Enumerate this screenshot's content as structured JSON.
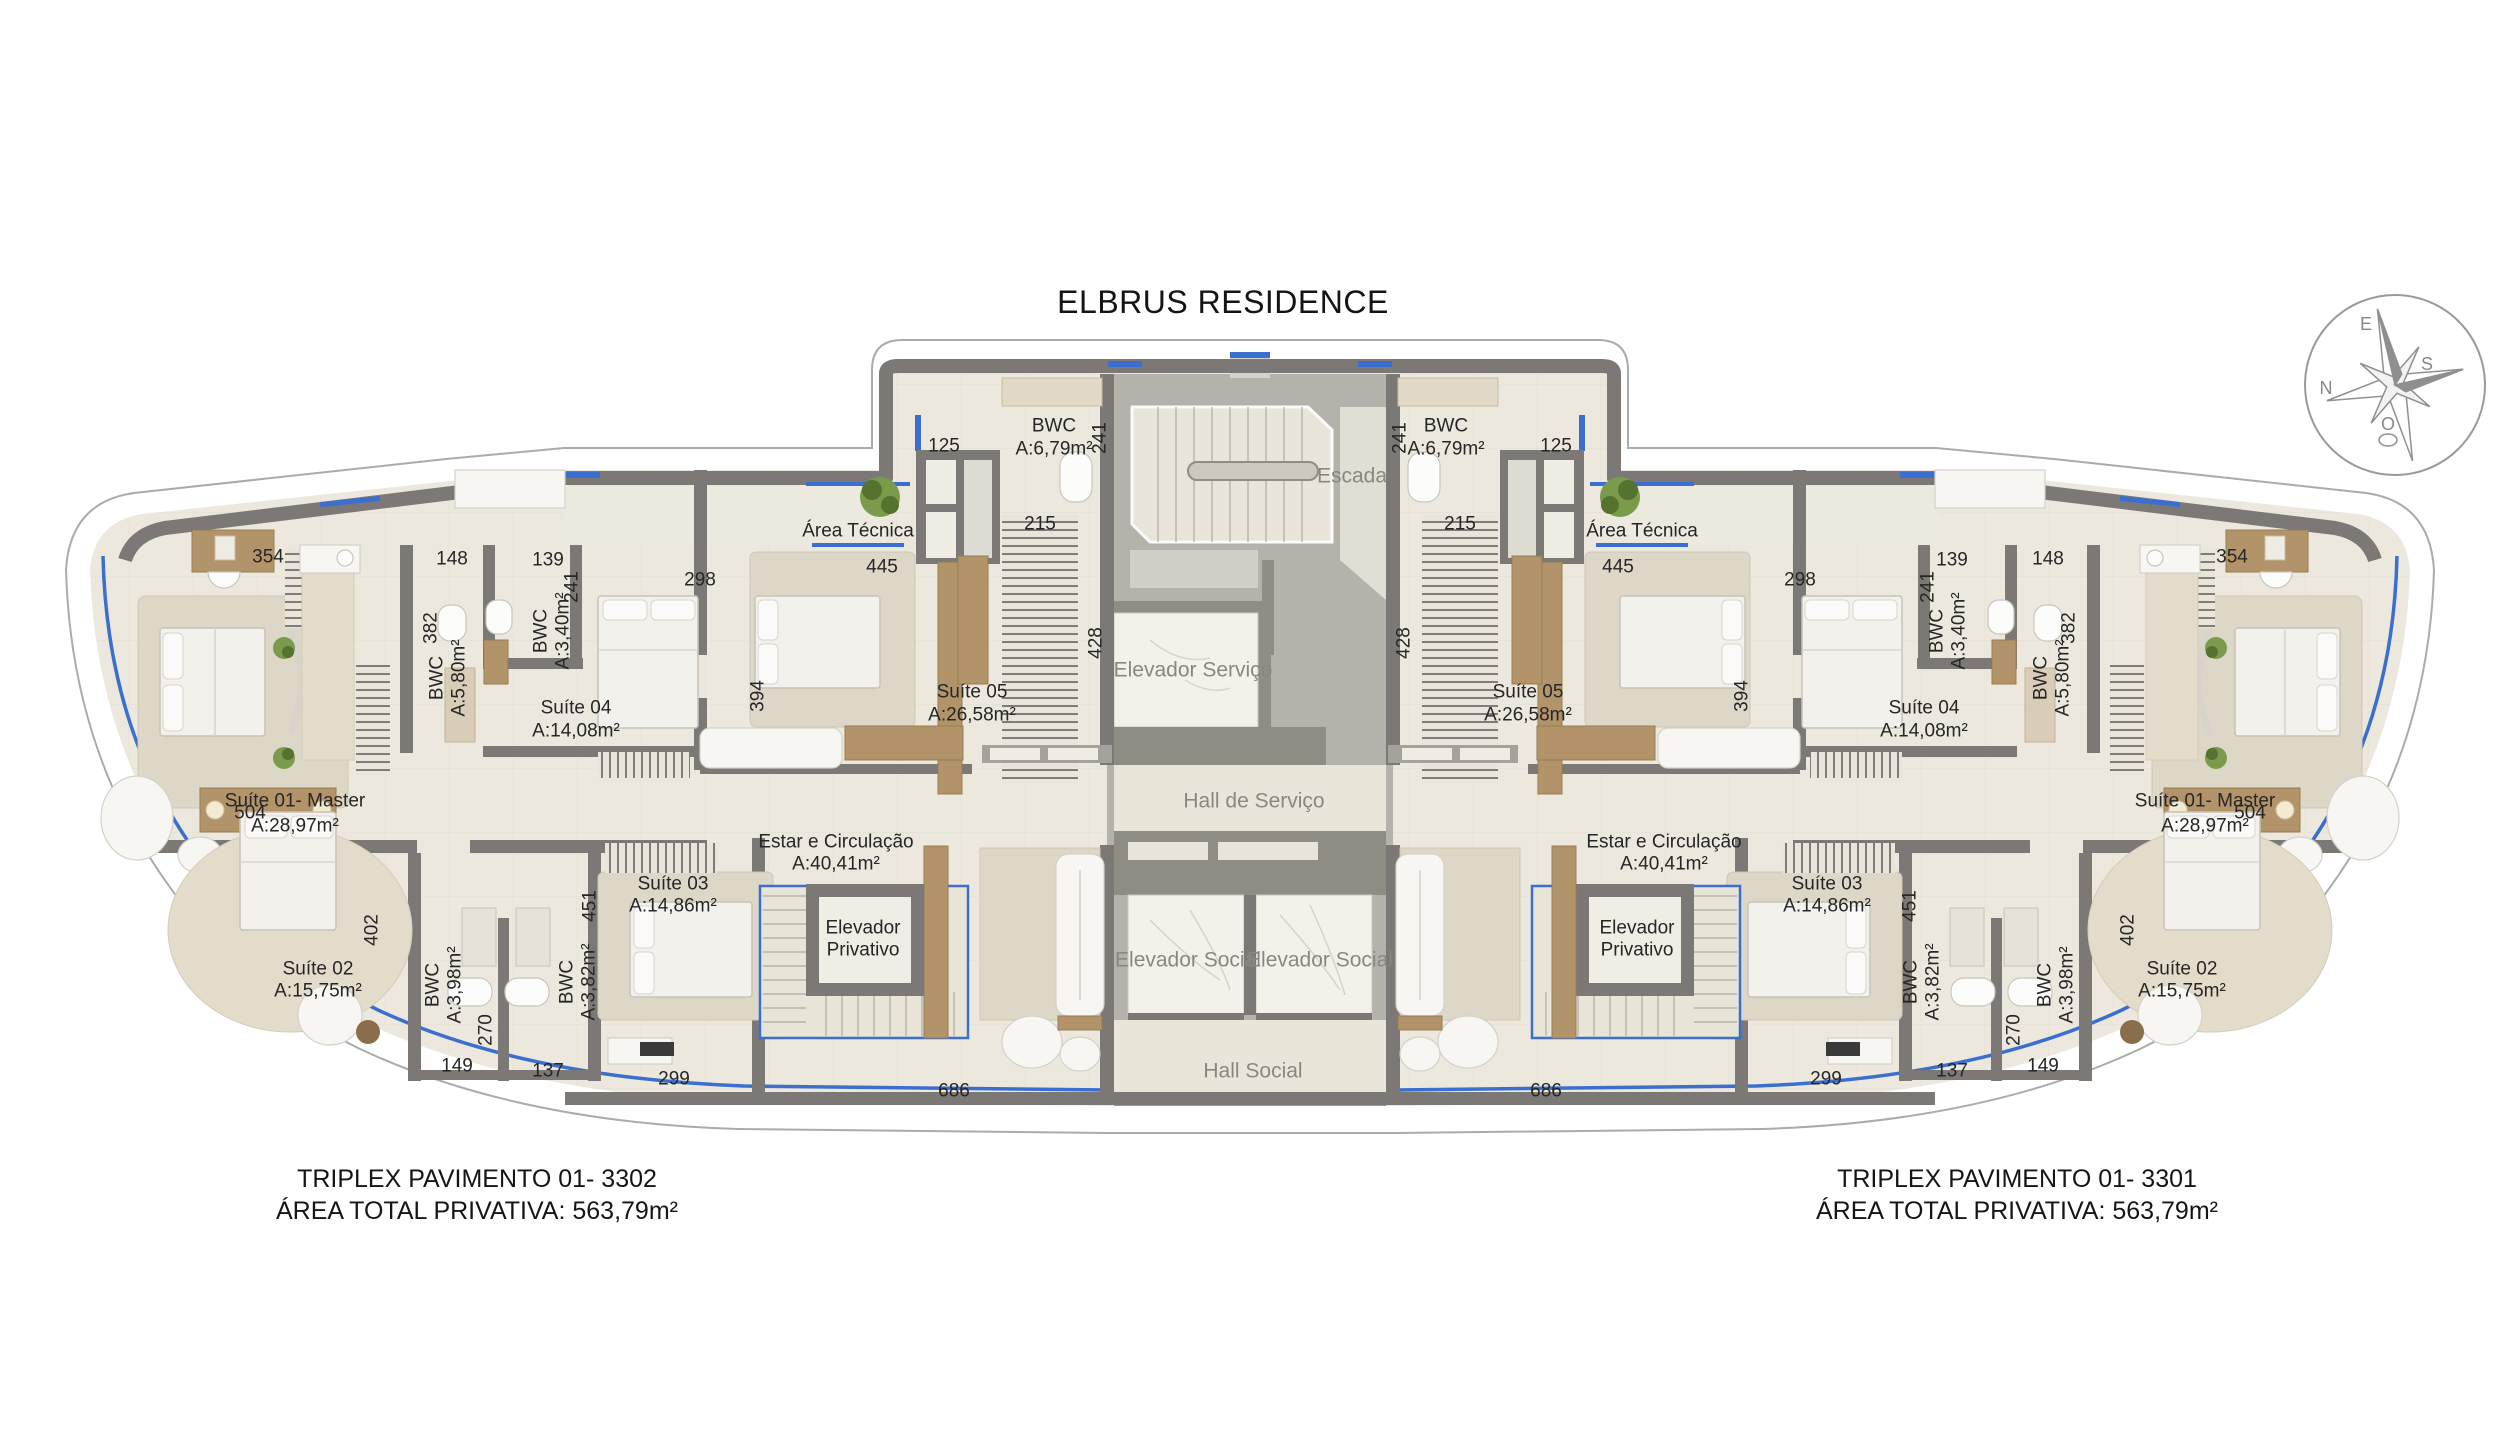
{
  "title": "ELBRUS RESIDENCE",
  "captions": {
    "left": {
      "line1": "TRIPLEX PAVIMENTO 01- 3302",
      "line2": "ÁREA TOTAL PRIVATIVA: 563,79m²"
    },
    "right": {
      "line1": "TRIPLEX PAVIMENTO 01- 3301",
      "line2": "ÁREA TOTAL PRIVATIVA: 563,79m²"
    }
  },
  "colors": {
    "accent_blue": "#3a6fd0",
    "wall_gray": "#7b7876",
    "floor_beige": "#ece8dd",
    "core_gray": "#b5b2ab",
    "marble": "#f3f1ea",
    "wood": "#b2936a",
    "label_dark": "#262626",
    "label_gray": "#8a8781"
  },
  "compass": {
    "north": "N",
    "south": "S",
    "east": "E",
    "west": "O"
  },
  "plan_labels": [
    {
      "n": "room-escada",
      "t": "Escada",
      "x": 1352,
      "y": 476,
      "s": 21,
      "c": "g"
    },
    {
      "n": "room-elevador-servico",
      "t": "Elevador Serviço",
      "x": 1193,
      "y": 670,
      "s": 21,
      "c": "g"
    },
    {
      "n": "room-hall-servico",
      "t": "Hall de Serviço",
      "x": 1254,
      "y": 801,
      "s": 21,
      "c": "g"
    },
    {
      "n": "room-elevador-social-1",
      "t": "Elevador Social",
      "x": 1188,
      "y": 960,
      "s": 21,
      "c": "g"
    },
    {
      "n": "room-elevador-social-2",
      "t": "Elevador Social",
      "x": 1320,
      "y": 960,
      "s": 21,
      "c": "g"
    },
    {
      "n": "room-hall-social",
      "t": "Hall Social",
      "x": 1253,
      "y": 1071,
      "s": 21,
      "c": "g"
    },
    {
      "n": "dim-428-left",
      "t": "428",
      "x": 1096,
      "y": 643,
      "r": -90
    },
    {
      "n": "dim-428-right",
      "t": "428",
      "x": 1404,
      "y": 643,
      "r": -90
    },
    {
      "n": "label-bwc05-l1",
      "t": "BWC",
      "x": 1054,
      "y": 426
    },
    {
      "n": "label-bwc05-l2",
      "t": "A:6,79m²",
      "x": 1054,
      "y": 449
    },
    {
      "n": "dim-241a-l",
      "t": "241",
      "x": 1100,
      "y": 438,
      "r": -90
    },
    {
      "n": "dim-125-l",
      "t": "125",
      "x": 944,
      "y": 446
    },
    {
      "n": "dim-215-l",
      "t": "215",
      "x": 1040,
      "y": 524
    },
    {
      "n": "label-area-tecnica-l",
      "t": "Área Técnica",
      "x": 858,
      "y": 531
    },
    {
      "n": "dim-445-l",
      "t": "445",
      "x": 882,
      "y": 567
    },
    {
      "n": "dim-298-l",
      "t": "298",
      "x": 700,
      "y": 580
    },
    {
      "n": "label-suite05-l1",
      "t": "Suíte 05",
      "x": 972,
      "y": 692
    },
    {
      "n": "label-suite05-l2",
      "t": "A:26,58m²",
      "x": 972,
      "y": 715
    },
    {
      "n": "dim-394-l",
      "t": "394",
      "x": 758,
      "y": 696,
      "r": -90
    },
    {
      "n": "dim-354-l",
      "t": "354",
      "x": 268,
      "y": 557
    },
    {
      "n": "dim-148-l",
      "t": "148",
      "x": 452,
      "y": 559
    },
    {
      "n": "dim-139-l",
      "t": "139",
      "x": 548,
      "y": 560
    },
    {
      "n": "dim-241b-l",
      "t": "241",
      "x": 572,
      "y": 587,
      "r": -90
    },
    {
      "n": "label-bwc340-l1",
      "t": "BWC",
      "x": 541,
      "y": 631,
      "r": -90
    },
    {
      "n": "label-bwc340-l2",
      "t": "A:3,40m²",
      "x": 563,
      "y": 631,
      "r": -90
    },
    {
      "n": "dim-382-l",
      "t": "382",
      "x": 431,
      "y": 628,
      "r": -90
    },
    {
      "n": "label-bwc580-l1",
      "t": "BWC",
      "x": 437,
      "y": 678,
      "r": -90
    },
    {
      "n": "label-bwc580-l2",
      "t": "A:5,80m²",
      "x": 459,
      "y": 678,
      "r": -90
    },
    {
      "n": "label-suite04-l1",
      "t": "Suíte 04",
      "x": 576,
      "y": 708
    },
    {
      "n": "label-suite04-l2",
      "t": "A:14,08m²",
      "x": 576,
      "y": 731
    },
    {
      "n": "label-suite01-l1",
      "t": "Suíte 01- Master",
      "x": 295,
      "y": 801
    },
    {
      "n": "label-suite01-l2",
      "t": "A:28,97m²",
      "x": 295,
      "y": 826
    },
    {
      "n": "dim-504-l",
      "t": "504",
      "x": 250,
      "y": 813
    },
    {
      "n": "label-suite02-l1",
      "t": "Suíte 02",
      "x": 318,
      "y": 969
    },
    {
      "n": "label-suite02-l2",
      "t": "A:15,75m²",
      "x": 318,
      "y": 991
    },
    {
      "n": "dim-402-l",
      "t": "402",
      "x": 372,
      "y": 930,
      "r": -90
    },
    {
      "n": "label-bwc398-l1",
      "t": "BWC",
      "x": 433,
      "y": 985,
      "r": -90
    },
    {
      "n": "label-bwc398-l2",
      "t": "A:3,98m²",
      "x": 455,
      "y": 985,
      "r": -90
    },
    {
      "n": "dim-270-l",
      "t": "270",
      "x": 486,
      "y": 1030,
      "r": -90
    },
    {
      "n": "dim-149-l",
      "t": "149",
      "x": 457,
      "y": 1066
    },
    {
      "n": "dim-137-l",
      "t": "137",
      "x": 548,
      "y": 1071
    },
    {
      "n": "label-bwc382-l1",
      "t": "BWC",
      "x": 567,
      "y": 982,
      "r": -90
    },
    {
      "n": "label-bwc382-l2",
      "t": "A:3,82m²",
      "x": 589,
      "y": 982,
      "r": -90
    },
    {
      "n": "dim-451-l",
      "t": "451",
      "x": 590,
      "y": 906,
      "r": -90
    },
    {
      "n": "label-suite03-l1",
      "t": "Suíte 03",
      "x": 673,
      "y": 884
    },
    {
      "n": "label-suite03-l2",
      "t": "A:14,86m²",
      "x": 673,
      "y": 906
    },
    {
      "n": "label-estar-l1",
      "t": "Estar e Circulação",
      "x": 836,
      "y": 842
    },
    {
      "n": "label-estar-l2",
      "t": "A:40,41m²",
      "x": 836,
      "y": 864
    },
    {
      "n": "label-elevpriv-l1",
      "t": "Elevador",
      "x": 863,
      "y": 928
    },
    {
      "n": "label-elevpriv-l2",
      "t": "Privativo",
      "x": 863,
      "y": 950
    },
    {
      "n": "dim-299-l",
      "t": "299",
      "x": 674,
      "y": 1079
    },
    {
      "n": "dim-686-l",
      "t": "686",
      "x": 954,
      "y": 1091
    },
    {
      "n": "label-bwc05-r1",
      "t": "BWC",
      "x": 1446,
      "y": 426
    },
    {
      "n": "label-bwc05-r2",
      "t": "A:6,79m²",
      "x": 1446,
      "y": 449
    },
    {
      "n": "dim-241a-r",
      "t": "241",
      "x": 1400,
      "y": 438,
      "r": -90
    },
    {
      "n": "dim-125-r",
      "t": "125",
      "x": 1556,
      "y": 446
    },
    {
      "n": "dim-215-r",
      "t": "215",
      "x": 1460,
      "y": 524
    },
    {
      "n": "label-area-tecnica-r",
      "t": "Área Técnica",
      "x": 1642,
      "y": 531
    },
    {
      "n": "dim-445-r",
      "t": "445",
      "x": 1618,
      "y": 567
    },
    {
      "n": "dim-298-r",
      "t": "298",
      "x": 1800,
      "y": 580
    },
    {
      "n": "label-suite05-r1",
      "t": "Suíte 05",
      "x": 1528,
      "y": 692
    },
    {
      "n": "label-suite05-r2",
      "t": "A:26,58m²",
      "x": 1528,
      "y": 715
    },
    {
      "n": "dim-394-r",
      "t": "394",
      "x": 1742,
      "y": 696,
      "r": -90
    },
    {
      "n": "dim-354-r",
      "t": "354",
      "x": 2232,
      "y": 557
    },
    {
      "n": "dim-148-r",
      "t": "148",
      "x": 2048,
      "y": 559
    },
    {
      "n": "dim-139-r",
      "t": "139",
      "x": 1952,
      "y": 560
    },
    {
      "n": "dim-241b-r",
      "t": "241",
      "x": 1928,
      "y": 587,
      "r": -90
    },
    {
      "n": "label-bwc340-r1",
      "t": "BWC",
      "x": 1937,
      "y": 631,
      "r": -90
    },
    {
      "n": "label-bwc340-r2",
      "t": "A:3,40m²",
      "x": 1959,
      "y": 631,
      "r": -90
    },
    {
      "n": "dim-382-r",
      "t": "382",
      "x": 2069,
      "y": 628,
      "r": -90
    },
    {
      "n": "label-bwc580-r1",
      "t": "BWC",
      "x": 2041,
      "y": 678,
      "r": -90
    },
    {
      "n": "label-bwc580-r2",
      "t": "A:5,80m²",
      "x": 2063,
      "y": 678,
      "r": -90
    },
    {
      "n": "label-suite04-r1",
      "t": "Suíte 04",
      "x": 1924,
      "y": 708
    },
    {
      "n": "label-suite04-r2",
      "t": "A:14,08m²",
      "x": 1924,
      "y": 731
    },
    {
      "n": "label-suite01-r1",
      "t": "Suíte 01- Master",
      "x": 2205,
      "y": 801
    },
    {
      "n": "label-suite01-r2",
      "t": "A:28,97m²",
      "x": 2205,
      "y": 826
    },
    {
      "n": "dim-504-r",
      "t": "504",
      "x": 2250,
      "y": 813
    },
    {
      "n": "label-suite02-r1",
      "t": "Suíte 02",
      "x": 2182,
      "y": 969
    },
    {
      "n": "label-suite02-r2",
      "t": "A:15,75m²",
      "x": 2182,
      "y": 991
    },
    {
      "n": "dim-402-r",
      "t": "402",
      "x": 2128,
      "y": 930,
      "r": -90
    },
    {
      "n": "label-bwc398-r1",
      "t": "BWC",
      "x": 2045,
      "y": 985,
      "r": -90
    },
    {
      "n": "label-bwc398-r2",
      "t": "A:3,98m²",
      "x": 2067,
      "y": 985,
      "r": -90
    },
    {
      "n": "dim-270-r",
      "t": "270",
      "x": 2014,
      "y": 1030,
      "r": -90
    },
    {
      "n": "dim-149-r",
      "t": "149",
      "x": 2043,
      "y": 1066
    },
    {
      "n": "dim-137-r",
      "t": "137",
      "x": 1952,
      "y": 1071
    },
    {
      "n": "label-bwc382-r1",
      "t": "BWC",
      "x": 1911,
      "y": 982,
      "r": -90
    },
    {
      "n": "label-bwc382-r2",
      "t": "A:3,82m²",
      "x": 1933,
      "y": 982,
      "r": -90
    },
    {
      "n": "dim-451-r",
      "t": "451",
      "x": 1910,
      "y": 906,
      "r": -90
    },
    {
      "n": "label-suite03-r1",
      "t": "Suíte 03",
      "x": 1827,
      "y": 884
    },
    {
      "n": "label-suite03-r2",
      "t": "A:14,86m²",
      "x": 1827,
      "y": 906
    },
    {
      "n": "label-estar-r1",
      "t": "Estar e Circulação",
      "x": 1664,
      "y": 842
    },
    {
      "n": "label-estar-r2",
      "t": "A:40,41m²",
      "x": 1664,
      "y": 864
    },
    {
      "n": "label-elevpriv-r1",
      "t": "Elevador",
      "x": 1637,
      "y": 928
    },
    {
      "n": "label-elevpriv-r2",
      "t": "Privativo",
      "x": 1637,
      "y": 950
    },
    {
      "n": "dim-299-r",
      "t": "299",
      "x": 1826,
      "y": 1079
    },
    {
      "n": "dim-686-r",
      "t": "686",
      "x": 1546,
      "y": 1091
    },
    {
      "n": "compass-letter-n",
      "t": "N",
      "x": 2326,
      "y": 388,
      "s": 18,
      "c": "g"
    },
    {
      "n": "compass-letter-s",
      "t": "S",
      "x": 2427,
      "y": 364,
      "s": 18,
      "c": "g"
    },
    {
      "n": "compass-letter-e",
      "t": "E",
      "x": 2366,
      "y": 324,
      "s": 18,
      "c": "g"
    },
    {
      "n": "compass-letter-o",
      "t": "O",
      "x": 2388,
      "y": 424,
      "s": 18,
      "c": "g"
    }
  ]
}
